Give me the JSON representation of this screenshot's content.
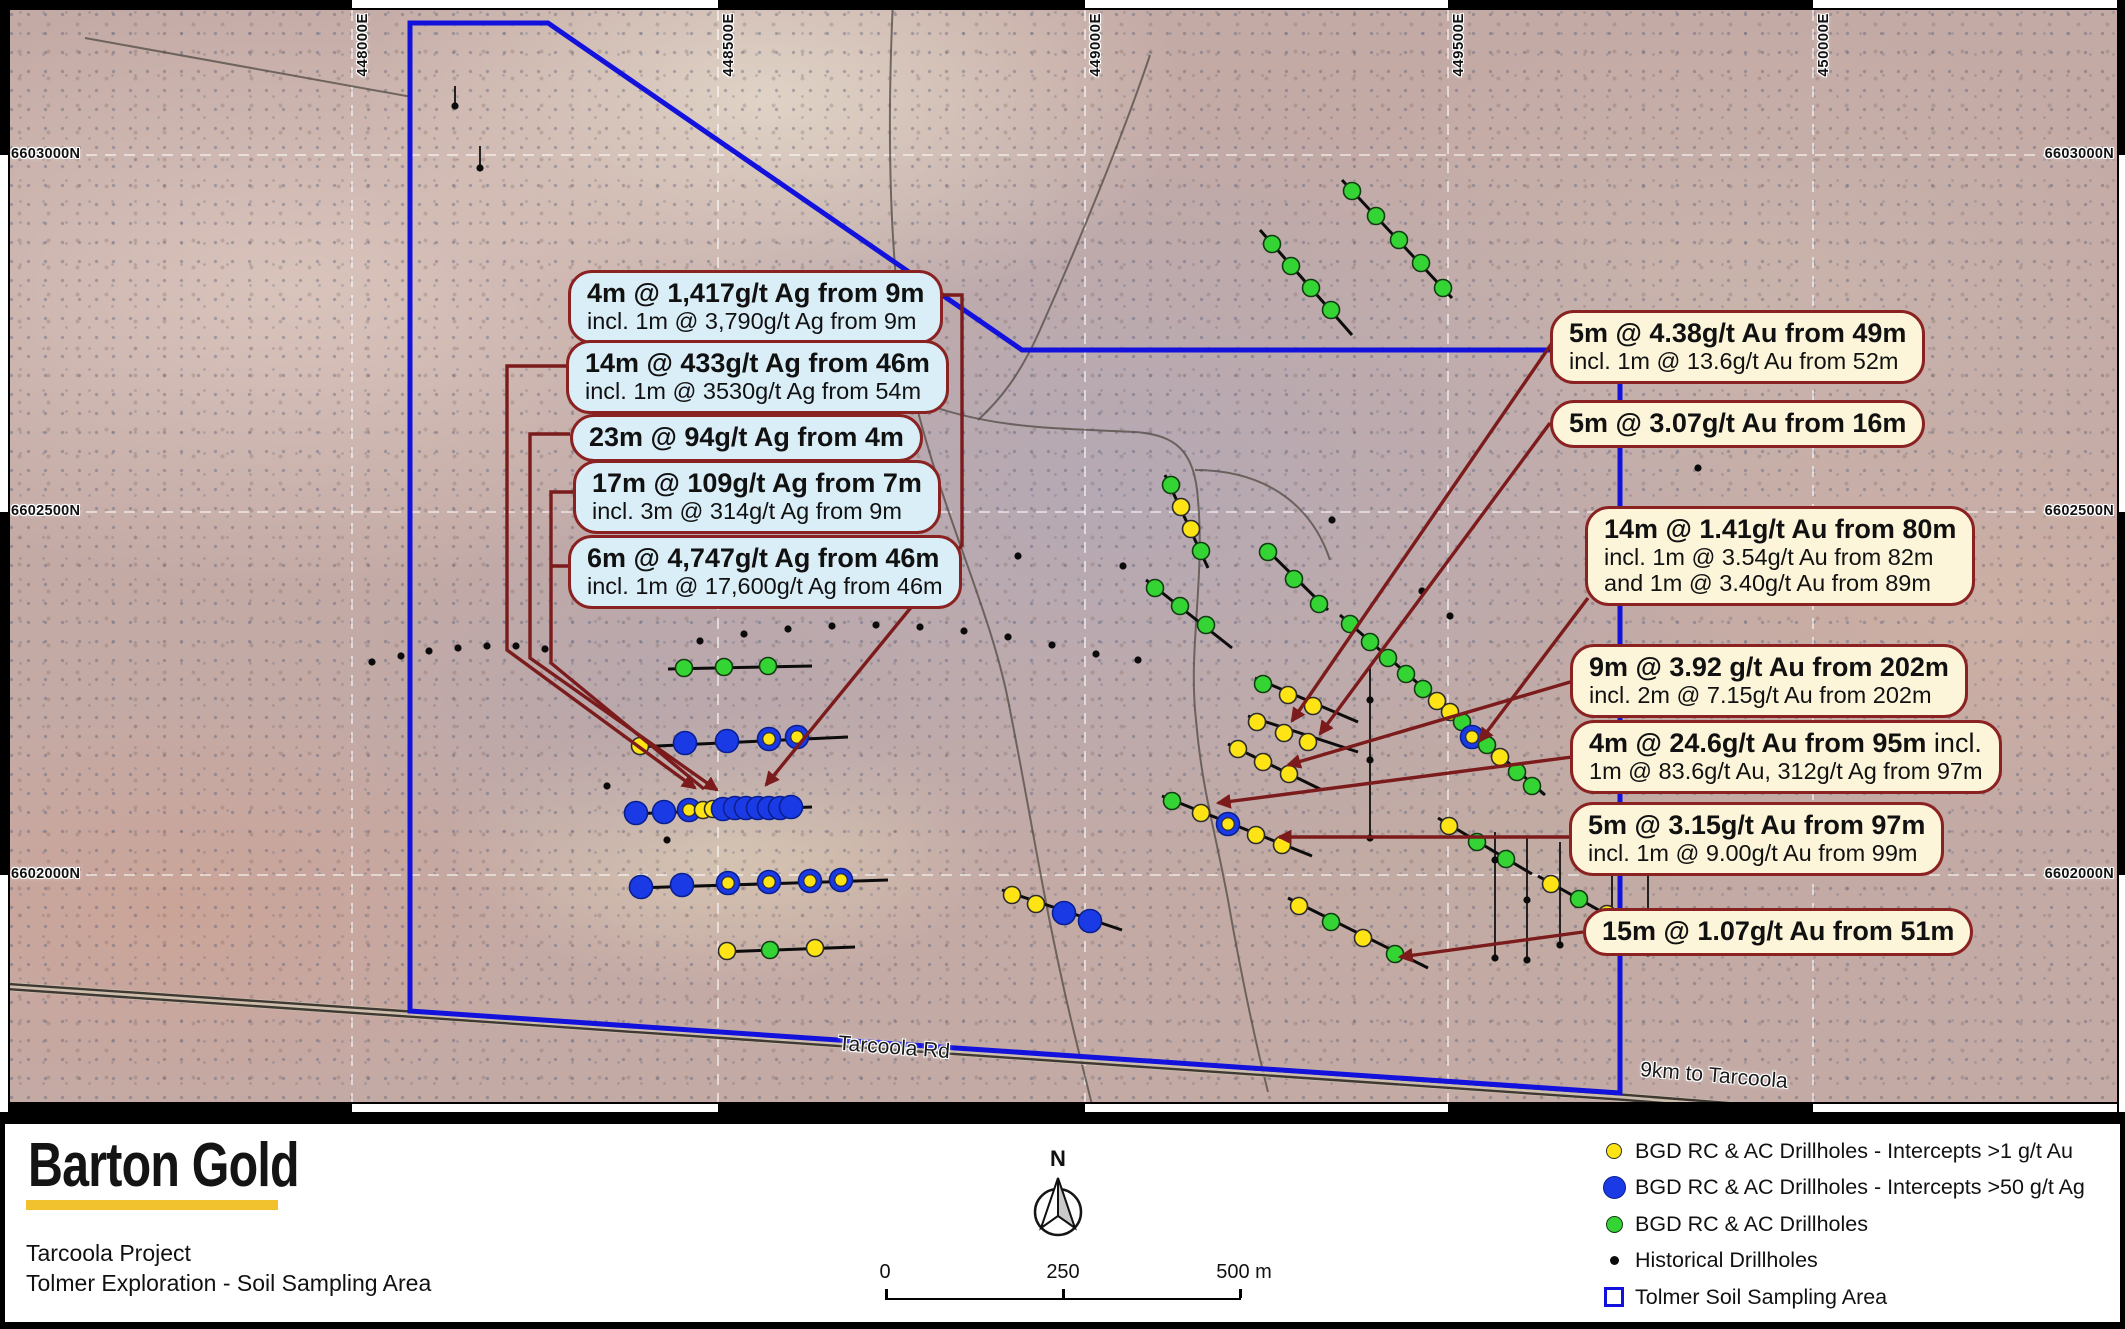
{
  "figure": {
    "logo": "Barton Gold",
    "project": "Tarcoola Project",
    "subtitle": "Tolmer Exploration - Soil Sampling Area",
    "north": "N",
    "scalebar": {
      "start": "0",
      "mid": "250",
      "end": "500 m"
    }
  },
  "legend": [
    {
      "swatch": "yellow-circle",
      "label": "BGD RC & AC Drillholes - Intercepts >1 g/t Au"
    },
    {
      "swatch": "blue-circle",
      "label": "BGD RC & AC Drillholes - Intercepts >50 g/t Ag"
    },
    {
      "swatch": "green-circle",
      "label": "BGD RC & AC Drillholes"
    },
    {
      "swatch": "black-dot",
      "label": "Historical Drillholes"
    },
    {
      "swatch": "area-outline",
      "label": "Tolmer Soil Sampling Area"
    }
  ],
  "map_labels": [
    {
      "text": "Tarcoola Rd",
      "x": 838,
      "y": 1036,
      "rot": 4.3
    },
    {
      "text": "9km to Tarcoola",
      "x": 1640,
      "y": 1064,
      "rot": 4.6
    }
  ],
  "coords": {
    "top": [
      {
        "label": "448000E",
        "x": 352
      },
      {
        "label": "448500E",
        "x": 718
      },
      {
        "label": "449000E",
        "x": 1085
      },
      {
        "label": "449500E",
        "x": 1448
      },
      {
        "label": "450000E",
        "x": 1813
      }
    ],
    "left": [
      {
        "label": "6603000N",
        "y": 155
      },
      {
        "label": "6602500N",
        "y": 512
      },
      {
        "label": "6602000N",
        "y": 875
      }
    ],
    "right": [
      {
        "label": "6603000N",
        "y": 155
      },
      {
        "label": "6602500N",
        "y": 512
      },
      {
        "label": "6602000N",
        "y": 875
      }
    ]
  },
  "callouts_left": [
    {
      "x": 568,
      "y": 270,
      "lines": [
        {
          "t": "4m @ 1,417g/t Ag from 9m"
        },
        {
          "t": "incl. 1m @ 3,790g/t Ag from 9m"
        }
      ]
    },
    {
      "x": 566,
      "y": 340,
      "lines": [
        {
          "t": "14m @ 433g/t Ag from 46m"
        },
        {
          "t": "incl. 1m @ 3530g/t Ag from 54m"
        }
      ]
    },
    {
      "x": 570,
      "y": 414,
      "lines": [
        {
          "t": "23m @ 94g/t Ag from 4m"
        }
      ]
    },
    {
      "x": 573,
      "y": 460,
      "lines": [
        {
          "t": "17m @ 109g/t Ag from 7m"
        },
        {
          "t": "incl. 3m @ 314g/t Ag from 9m"
        }
      ]
    },
    {
      "x": 568,
      "y": 535,
      "lines": [
        {
          "t": "6m @ 4,747g/t Ag from 46m"
        },
        {
          "t": "incl. 1m @ 17,600g/t Ag from 46m"
        }
      ]
    }
  ],
  "callouts_right": [
    {
      "x": 1550,
      "y": 310,
      "lines": [
        {
          "t": "5m @ 4.38g/t Au from 49m"
        },
        {
          "t": "incl. 1m @ 13.6g/t Au from 52m"
        }
      ]
    },
    {
      "x": 1550,
      "y": 400,
      "lines": [
        {
          "t": "5m @ 3.07g/t Au from 16m"
        }
      ]
    },
    {
      "x": 1585,
      "y": 506,
      "lines": [
        {
          "t": "14m @ 1.41g/t Au from 80m"
        },
        {
          "t": "incl. 1m @ 3.54g/t Au from 82m"
        },
        {
          "t": "and 1m @ 3.40g/t Au from 89m"
        }
      ]
    },
    {
      "x": 1570,
      "y": 644,
      "lines": [
        {
          "t": "9m @ 3.92 g/t Au from 202m"
        },
        {
          "t": "incl. 2m @ 7.15g/t Au from 202m"
        }
      ]
    },
    {
      "x": 1570,
      "y": 720,
      "lines": [
        {
          "t": "4m @ 24.6g/t Au from 95m",
          "tail": " incl."
        },
        {
          "t": "1m @ 83.6g/t Au, 312g/t Ag from 97m"
        }
      ]
    },
    {
      "x": 1569,
      "y": 802,
      "lines": [
        {
          "t": "5m @ 3.15g/t Au from 97m"
        },
        {
          "t": "incl. 1m @ 9.00g/t Au from 99m"
        }
      ]
    },
    {
      "x": 1583,
      "y": 908,
      "lines": [
        {
          "t": "15m @ 1.07g/t Au from 51m"
        }
      ]
    }
  ],
  "polygon": [
    [
      410,
      23
    ],
    [
      548,
      23
    ],
    [
      1022,
      350
    ],
    [
      1620,
      350
    ],
    [
      1620,
      1093
    ],
    [
      410,
      1011
    ]
  ],
  "roads": {
    "main": "M0,986 L1620,1097 L1960,1124",
    "tracks": [
      "M893,0 C886,150 890,300 915,400 C945,520 990,610 1008,700 C1028,800 1040,880 1062,980 C1075,1040 1085,1075 1092,1105",
      "M915,400 C990,430 1060,428 1135,432 C1175,435 1195,450 1198,500 C1205,580 1188,650 1196,720 C1202,790 1215,830 1228,900 C1242,980 1255,1040 1268,1092",
      "M1150,55 C1125,130 1080,240 1040,330 C1020,375 1000,400 978,420",
      "M85,38 L412,97",
      "M1195,470 C1260,470 1310,500 1330,560"
    ]
  },
  "drill_lines": [
    {
      "pts": [
        [
          668,
          669
        ],
        [
          812,
          666
        ]
      ],
      "m": [
        [
          684,
          668,
          "g"
        ],
        [
          724,
          667,
          "g"
        ],
        [
          768,
          666,
          "g"
        ]
      ]
    },
    {
      "pts": [
        [
          636,
          747
        ],
        [
          848,
          737
        ]
      ],
      "m": [
        [
          640,
          746,
          "y"
        ],
        [
          685,
          743,
          "b"
        ],
        [
          727,
          741,
          "b"
        ],
        [
          769,
          739,
          "by"
        ],
        [
          797,
          737,
          "by"
        ]
      ]
    },
    {
      "pts": [
        [
          628,
          814
        ],
        [
          812,
          807
        ]
      ],
      "m": [
        [
          636,
          813,
          "b"
        ],
        [
          664,
          812,
          "b"
        ],
        [
          689,
          810,
          "by"
        ],
        [
          703,
          810,
          "y"
        ],
        [
          713,
          809,
          "y"
        ],
        [
          723,
          809,
          "b"
        ],
        [
          735,
          808,
          "b"
        ],
        [
          746,
          808,
          "b"
        ],
        [
          758,
          808,
          "b"
        ],
        [
          769,
          808,
          "b"
        ],
        [
          780,
          808,
          "b"
        ],
        [
          791,
          807,
          "b"
        ]
      ]
    },
    {
      "pts": [
        [
          634,
          888
        ],
        [
          888,
          880
        ]
      ],
      "m": [
        [
          641,
          887,
          "b"
        ],
        [
          682,
          885,
          "b"
        ],
        [
          728,
          883,
          "by"
        ],
        [
          769,
          882,
          "by"
        ],
        [
          810,
          881,
          "by"
        ],
        [
          841,
          880,
          "by"
        ]
      ]
    },
    {
      "pts": [
        [
          720,
          952
        ],
        [
          855,
          947
        ]
      ],
      "m": [
        [
          727,
          951,
          "y"
        ],
        [
          770,
          950,
          "g"
        ],
        [
          815,
          948,
          "y"
        ]
      ]
    },
    {
      "pts": [
        [
          1002,
          890
        ],
        [
          1122,
          930
        ]
      ],
      "m": [
        [
          1012,
          895,
          "y"
        ],
        [
          1036,
          904,
          "y"
        ],
        [
          1064,
          913,
          "b"
        ],
        [
          1090,
          921,
          "b"
        ]
      ]
    },
    {
      "pts": [
        [
          1342,
          180
        ],
        [
          1452,
          298
        ]
      ],
      "m": [
        [
          1352,
          191,
          "g"
        ],
        [
          1376,
          216,
          "g"
        ],
        [
          1399,
          240,
          "g"
        ],
        [
          1421,
          263,
          "g"
        ],
        [
          1443,
          288,
          "g"
        ]
      ]
    },
    {
      "pts": [
        [
          1260,
          230
        ],
        [
          1352,
          335
        ]
      ],
      "m": [
        [
          1272,
          244,
          "g"
        ],
        [
          1291,
          266,
          "g"
        ],
        [
          1311,
          288,
          "g"
        ],
        [
          1331,
          310,
          "g"
        ]
      ]
    },
    {
      "pts": [
        [
          1165,
          475
        ],
        [
          1208,
          568
        ]
      ],
      "m": [
        [
          1171,
          485,
          "g"
        ],
        [
          1181,
          507,
          "y"
        ],
        [
          1191,
          529,
          "y"
        ],
        [
          1201,
          551,
          "g"
        ]
      ]
    },
    {
      "pts": [
        [
          1146,
          580
        ],
        [
          1232,
          648
        ]
      ],
      "m": [
        [
          1155,
          588,
          "g"
        ],
        [
          1180,
          606,
          "g"
        ],
        [
          1206,
          625,
          "g"
        ]
      ]
    },
    {
      "pts": [
        [
          1262,
          545
        ],
        [
          1328,
          610
        ]
      ],
      "m": [
        [
          1268,
          552,
          "g"
        ],
        [
          1294,
          579,
          "g"
        ],
        [
          1319,
          604,
          "g"
        ]
      ]
    },
    {
      "pts": [
        [
          1340,
          615
        ],
        [
          1545,
          795
        ]
      ],
      "m": [
        [
          1350,
          624,
          "g"
        ],
        [
          1370,
          642,
          "g"
        ],
        [
          1388,
          658,
          "g"
        ],
        [
          1406,
          674,
          "g"
        ],
        [
          1423,
          689,
          "g"
        ],
        [
          1437,
          701,
          "y"
        ],
        [
          1450,
          712,
          "y"
        ],
        [
          1462,
          722,
          "g"
        ],
        [
          1472,
          737,
          "by"
        ],
        [
          1487,
          745,
          "g"
        ],
        [
          1500,
          757,
          "y"
        ],
        [
          1517,
          772,
          "g"
        ],
        [
          1532,
          786,
          "g"
        ]
      ]
    },
    {
      "pts": [
        [
          1255,
          678
        ],
        [
          1358,
          722
        ]
      ],
      "m": [
        [
          1263,
          684,
          "g"
        ],
        [
          1288,
          695,
          "y"
        ],
        [
          1313,
          706,
          "y"
        ]
      ]
    },
    {
      "pts": [
        [
          1248,
          716
        ],
        [
          1358,
          752
        ]
      ],
      "m": [
        [
          1257,
          722,
          "y"
        ],
        [
          1284,
          733,
          "y"
        ],
        [
          1308,
          742,
          "y"
        ]
      ]
    },
    {
      "pts": [
        [
          1228,
          744
        ],
        [
          1322,
          790
        ]
      ],
      "m": [
        [
          1238,
          749,
          "y"
        ],
        [
          1263,
          762,
          "y"
        ],
        [
          1289,
          774,
          "y"
        ]
      ]
    },
    {
      "pts": [
        [
          1162,
          796
        ],
        [
          1312,
          856
        ]
      ],
      "m": [
        [
          1172,
          801,
          "g"
        ],
        [
          1201,
          813,
          "y"
        ],
        [
          1228,
          824,
          "by"
        ],
        [
          1256,
          835,
          "y"
        ],
        [
          1282,
          845,
          "y"
        ]
      ]
    },
    {
      "pts": [
        [
          1288,
          898
        ],
        [
          1428,
          968
        ]
      ],
      "m": [
        [
          1299,
          906,
          "y"
        ],
        [
          1331,
          922,
          "g"
        ],
        [
          1363,
          938,
          "y"
        ],
        [
          1395,
          954,
          "g"
        ]
      ]
    },
    {
      "pts": [
        [
          1438,
          818
        ],
        [
          1532,
          874
        ]
      ],
      "m": [
        [
          1449,
          826,
          "y"
        ],
        [
          1477,
          842,
          "g"
        ],
        [
          1506,
          859,
          "g"
        ]
      ]
    },
    {
      "pts": [
        [
          1538,
          876
        ],
        [
          1652,
          940
        ]
      ],
      "m": [
        [
          1551,
          884,
          "y"
        ],
        [
          1579,
          899,
          "g"
        ],
        [
          1607,
          914,
          "y"
        ],
        [
          1634,
          929,
          "g"
        ]
      ]
    }
  ],
  "historical_vlines": [
    [
      455,
      86,
      106
    ],
    [
      480,
      146,
      168
    ],
    [
      1370,
      668,
      840
    ],
    [
      1495,
      832,
      958
    ],
    [
      1527,
      838,
      962
    ],
    [
      1560,
      842,
      948
    ],
    [
      1612,
      838,
      950
    ],
    [
      1648,
      842,
      955
    ]
  ],
  "historical_dots": [
    [
      455,
      106
    ],
    [
      480,
      168
    ],
    [
      372,
      662
    ],
    [
      401,
      656
    ],
    [
      429,
      651
    ],
    [
      458,
      648
    ],
    [
      487,
      646
    ],
    [
      516,
      646
    ],
    [
      545,
      649
    ],
    [
      607,
      786
    ],
    [
      667,
      840
    ],
    [
      700,
      641
    ],
    [
      744,
      634
    ],
    [
      788,
      629
    ],
    [
      832,
      626
    ],
    [
      876,
      625
    ],
    [
      920,
      627
    ],
    [
      964,
      631
    ],
    [
      1008,
      637
    ],
    [
      1052,
      645
    ],
    [
      1096,
      654
    ],
    [
      1138,
      660
    ],
    [
      1018,
      556
    ],
    [
      1123,
      566
    ],
    [
      1332,
      520
    ],
    [
      1422,
      591
    ],
    [
      1450,
      616
    ],
    [
      1662,
      534
    ],
    [
      1698,
      468
    ],
    [
      1370,
      700
    ],
    [
      1370,
      760
    ],
    [
      1370,
      838
    ],
    [
      1495,
      860
    ],
    [
      1495,
      958
    ],
    [
      1527,
      900
    ],
    [
      1527,
      960
    ],
    [
      1560,
      945
    ],
    [
      1612,
      870
    ],
    [
      1612,
      948
    ],
    [
      1648,
      953
    ]
  ],
  "leaders": [
    {
      "pts": [
        [
          566,
          366
        ],
        [
          507,
          366
        ],
        [
          507,
          650
        ],
        [
          695,
          788
        ]
      ],
      "arrow": true
    },
    {
      "pts": [
        [
          570,
          434
        ],
        [
          530,
          434
        ],
        [
          530,
          658
        ],
        [
          717,
          790
        ]
      ],
      "arrow": true
    },
    {
      "pts": [
        [
          573,
          492
        ],
        [
          551,
          492
        ],
        [
          551,
          663
        ],
        [
          704,
          789
        ]
      ],
      "arrow": false
    },
    {
      "pts": [
        [
          568,
          566
        ],
        [
          551,
          566
        ]
      ],
      "arrow": false
    },
    {
      "pts": [
        [
          940,
          295
        ],
        [
          962,
          295
        ],
        [
          962,
          545
        ],
        [
          766,
          785
        ]
      ],
      "arrow": true
    },
    {
      "pts": [
        [
          1552,
          343
        ],
        [
          1292,
          721
        ]
      ],
      "arrow": true
    },
    {
      "pts": [
        [
          1550,
          423
        ],
        [
          1320,
          734
        ]
      ],
      "arrow": true
    },
    {
      "pts": [
        [
          1588,
          598
        ],
        [
          1480,
          741
        ]
      ],
      "arrow": true
    },
    {
      "pts": [
        [
          1577,
          680
        ],
        [
          1288,
          765
        ]
      ],
      "arrow": true
    },
    {
      "pts": [
        [
          1572,
          757
        ],
        [
          1218,
          803
        ]
      ],
      "arrow": true
    },
    {
      "pts": [
        [
          1571,
          837
        ],
        [
          1279,
          837
        ]
      ],
      "arrow": true
    },
    {
      "pts": [
        [
          1583,
          932
        ],
        [
          1400,
          957
        ]
      ],
      "arrow": true
    }
  ],
  "colors": {
    "polygon": "#1312dc",
    "leader": "#7b1b1b",
    "callout_border": "#8b2222",
    "yellow": "#ffe415",
    "blue": "#1a3ae6",
    "green": "#35d435",
    "black": "#0b0b0b",
    "logo_underline": "#f2c12e"
  }
}
